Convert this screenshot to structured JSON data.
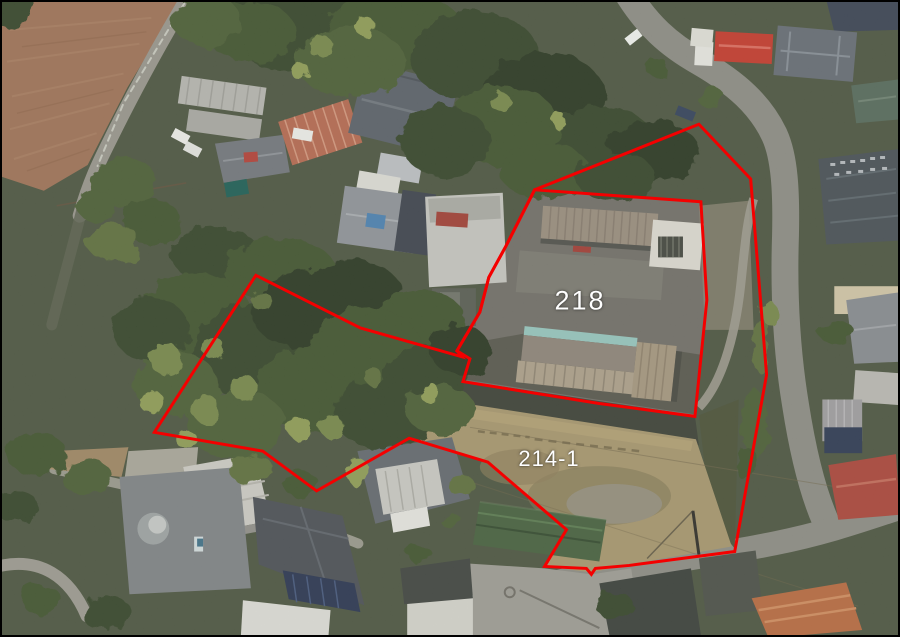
{
  "map": {
    "type": "aerial-photo-with-parcel-overlay",
    "annotation_color": "#f40000",
    "annotation_stroke_width": 3,
    "label_color": "#ffffff"
  },
  "parcels": [
    {
      "id": "218",
      "label": "218",
      "label_pos": {
        "x": 578,
        "y": 299
      },
      "outline": [
        [
          535,
          189
        ],
        [
          702,
          201
        ],
        [
          708,
          300
        ],
        [
          696,
          417
        ],
        [
          600,
          404
        ],
        [
          463,
          382
        ],
        [
          470,
          359
        ],
        [
          457,
          351
        ],
        [
          480,
          312
        ],
        [
          489,
          277
        ],
        [
          506,
          246
        ]
      ]
    },
    {
      "id": "214-1",
      "label": "214-1",
      "label_pos": {
        "x": 547,
        "y": 457
      },
      "outline": [
        [
          700,
          123
        ],
        [
          752,
          178
        ],
        [
          768,
          375
        ],
        [
          736,
          553
        ],
        [
          630,
          567
        ],
        [
          596,
          570
        ],
        [
          592,
          576
        ],
        [
          587,
          570
        ],
        [
          545,
          568
        ],
        [
          567,
          531
        ],
        [
          488,
          463
        ],
        [
          409,
          439
        ],
        [
          316,
          492
        ],
        [
          262,
          452
        ],
        [
          153,
          433
        ],
        [
          255,
          275
        ],
        [
          360,
          328
        ],
        [
          462,
          357
        ],
        [
          457,
          351
        ],
        [
          480,
          312
        ],
        [
          489,
          277
        ],
        [
          506,
          246
        ],
        [
          535,
          189
        ]
      ]
    }
  ]
}
